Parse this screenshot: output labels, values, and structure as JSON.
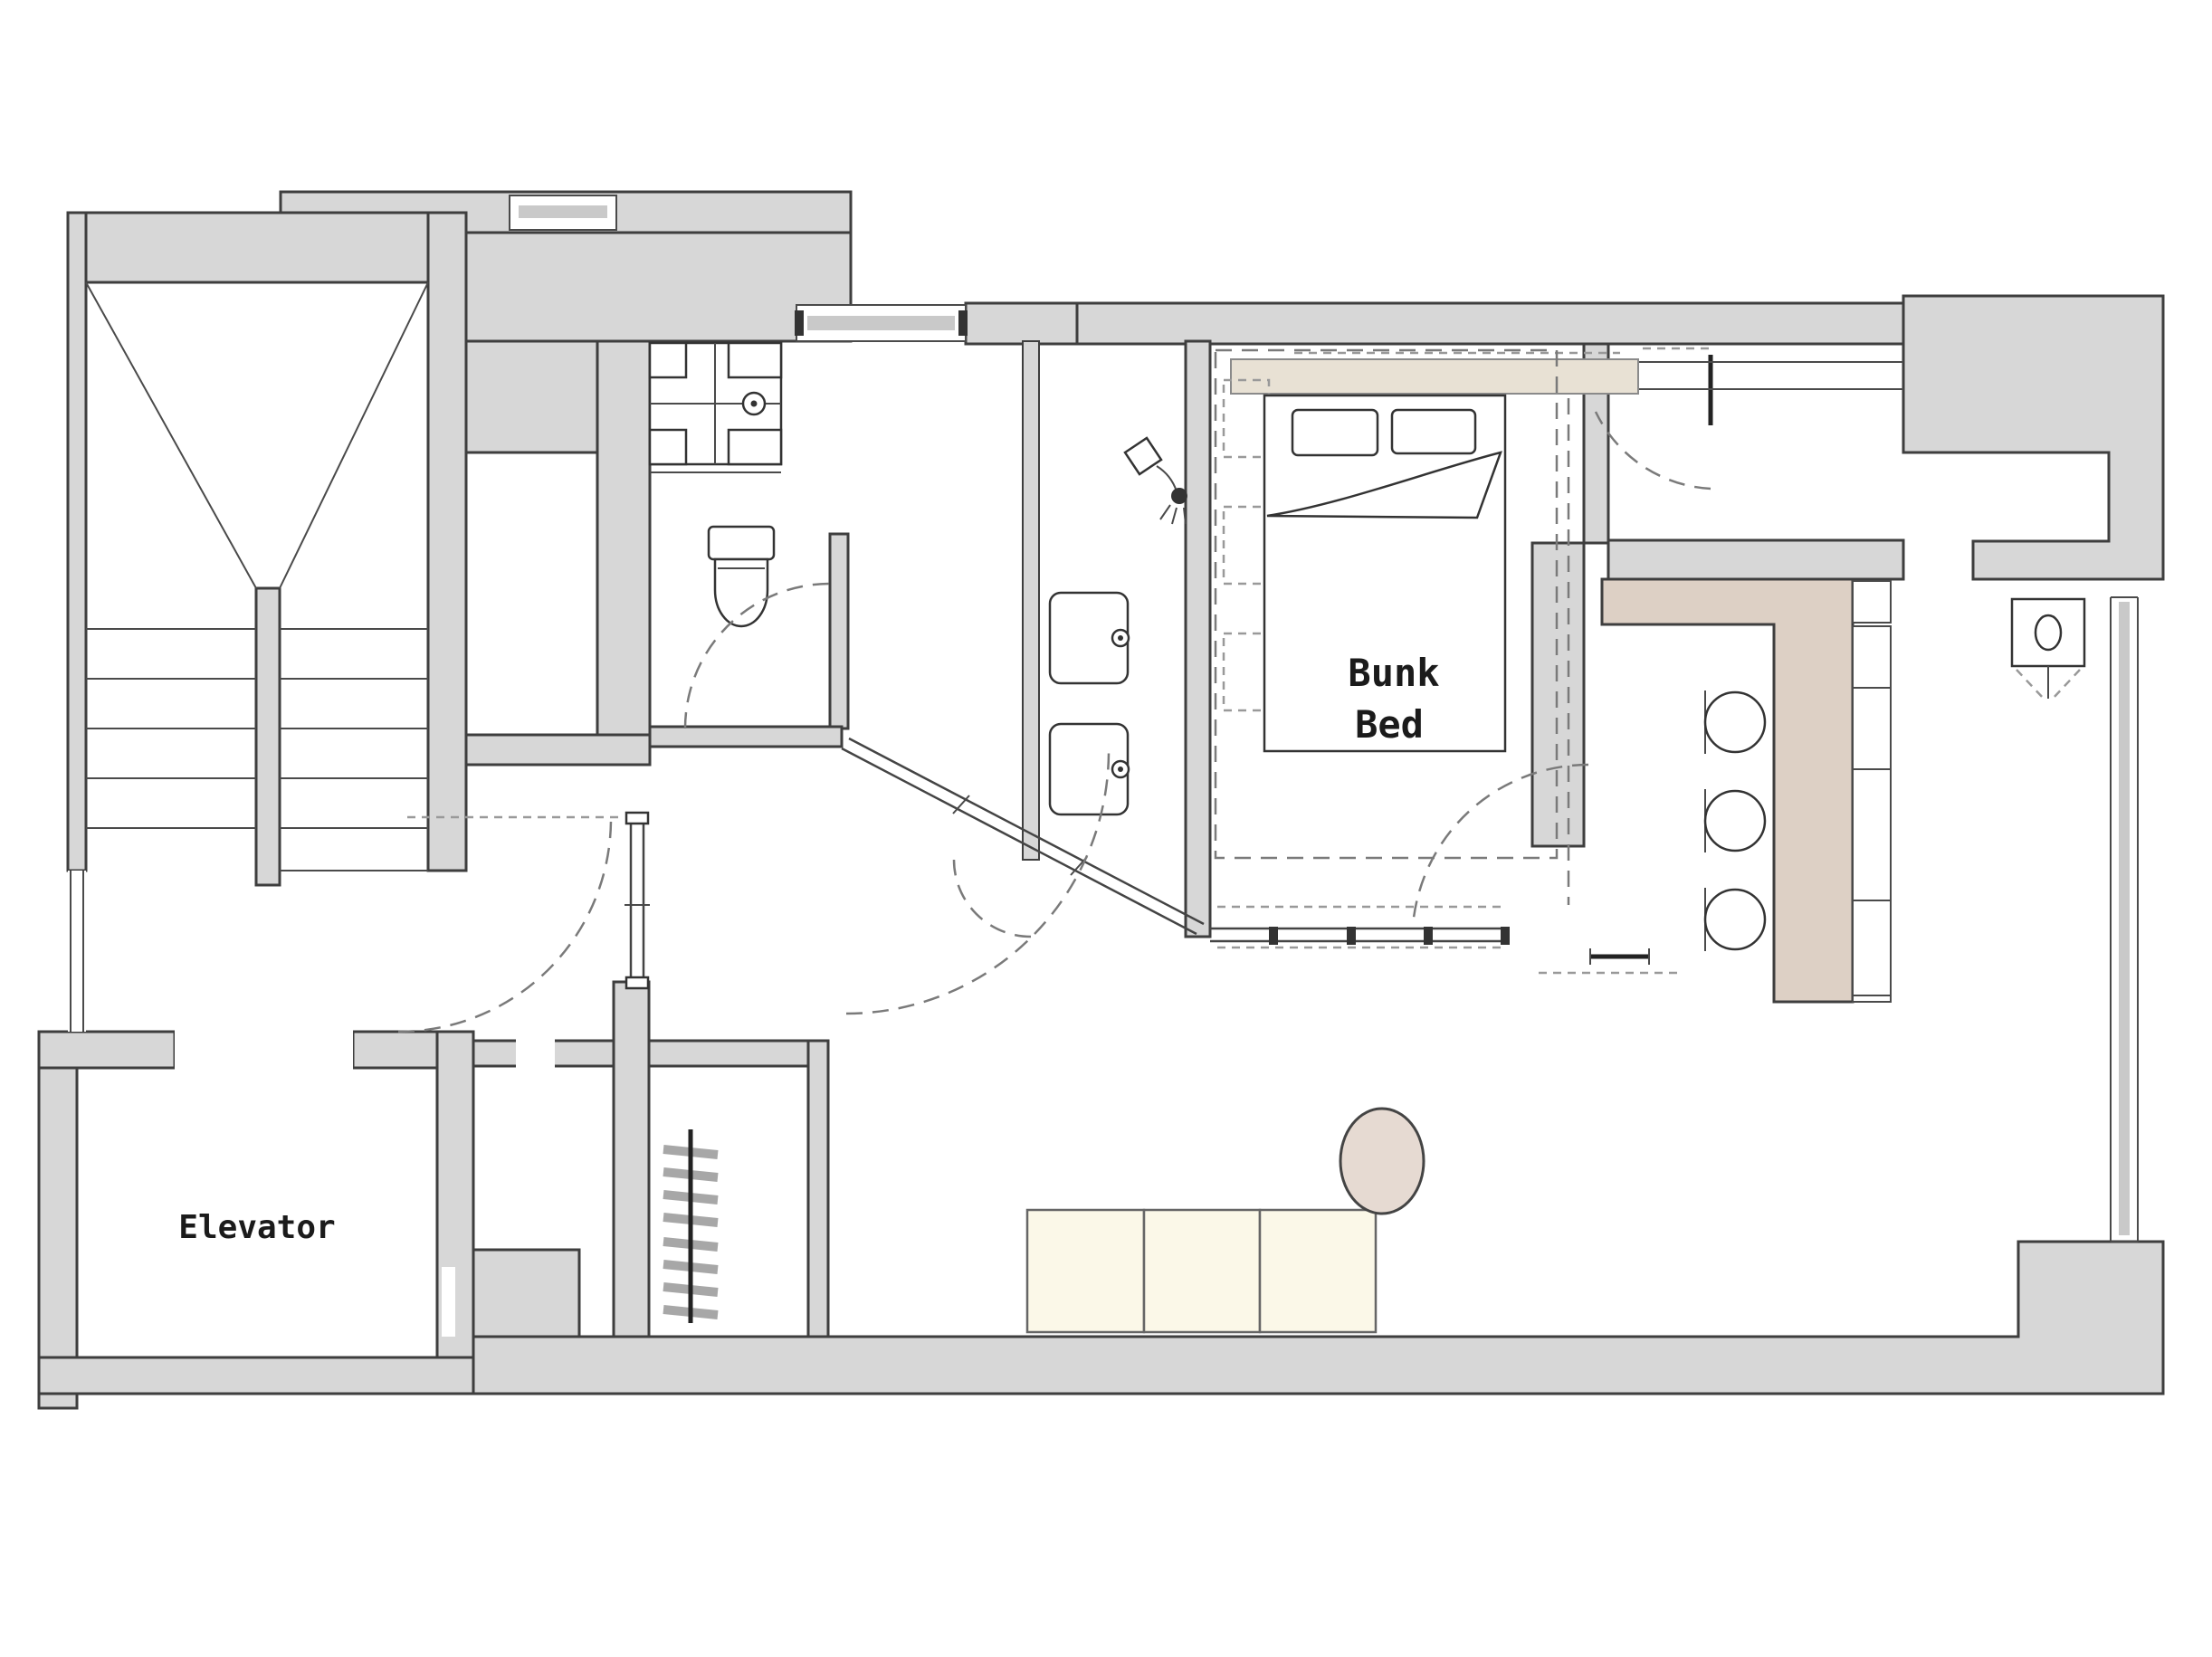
{
  "document": {
    "type": "architectural-floor-plan",
    "style": "hand-drawn-sketch"
  },
  "labels": {
    "elevator": "Elevator",
    "bunk_bed_line1": "Bunk",
    "bunk_bed_line2": "Bed"
  },
  "colors": {
    "wall_fill": "#d7d7d7",
    "wall_stroke": "#3e3e3e",
    "line": "#4a4a4a",
    "dash": "#7a7a7a",
    "counter_beige": "#ddd0c5",
    "wardrobe_beige": "#e8e1d4",
    "sofa_cream": "#fbf8e8",
    "table_blush": "#e6dad2",
    "window_bar": "#c9c9c9",
    "text_color": "#1b1b1b"
  },
  "fixtures": {
    "stair_flights": 2,
    "steps_per_flight": 5,
    "bar_stools": 3,
    "sofa_cushions": 3,
    "vanity_sinks": 2,
    "bed_pillows": 2,
    "radiator_fins": 8,
    "glass_partition_posts": 4,
    "windows": 4,
    "door_swing_arcs": 6
  },
  "icons": [
    "staircase",
    "washing-machine-icon",
    "toilet-icon",
    "shower-icon",
    "sink-icon",
    "kitchen-sink-icon",
    "bar-stool-icon",
    "radiator-icon",
    "bed",
    "ladder-icon",
    "sofa",
    "round-table",
    "door-swing-arc",
    "window"
  ]
}
